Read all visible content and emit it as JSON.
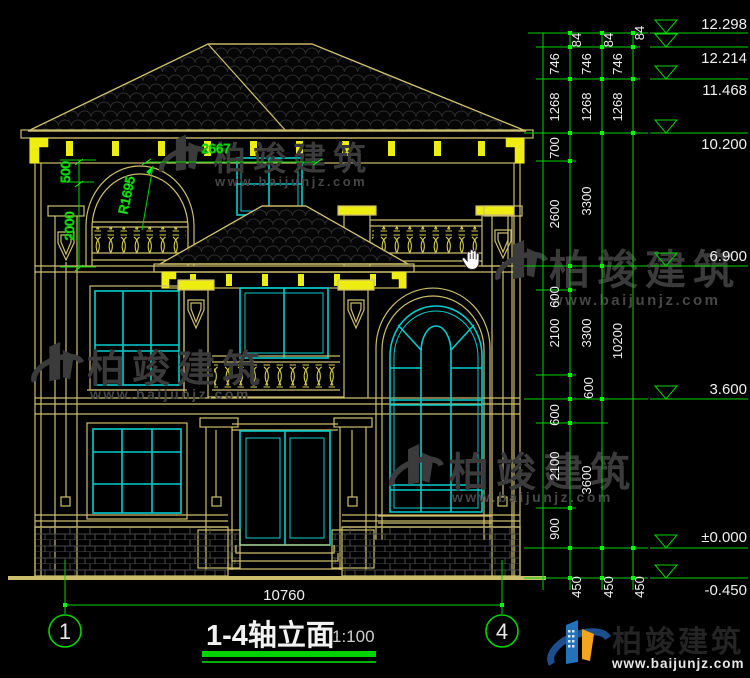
{
  "drawing": {
    "title": "1-4轴立面",
    "scale": "1:100",
    "axis_bubble_left": "1",
    "axis_bubble_right": "4",
    "bottom_overall_dim": "10760"
  },
  "left_dims": {
    "arch_width": "2667",
    "arch_radius": "R1695",
    "upper": "500",
    "lower": "2000"
  },
  "right_dims": {
    "chain1": [
      "84",
      "746",
      "1268",
      "700",
      "2600",
      "600",
      "2100",
      "600",
      "600",
      "2100",
      "900",
      "450"
    ],
    "chain2": [
      "84",
      "746",
      "1268",
      "3300",
      "3300",
      "3600",
      "450"
    ],
    "chain3": [
      "84",
      "746",
      "1268",
      "10200",
      "450"
    ]
  },
  "elevations": [
    "12.298",
    "12.214",
    "11.468",
    "10.200",
    "6.900",
    "3.600",
    "±0.000",
    "-0.450"
  ],
  "watermark": {
    "name": "柏竣建筑",
    "url": "www.baijunjz.com"
  },
  "logo": {
    "name": "柏竣建筑",
    "url": "www.baijunjz.com"
  },
  "cursor": {
    "type": "hand"
  },
  "colors": {
    "background": "#000000",
    "line_yellow": "#cdbe6e",
    "accent_yellow": "#eded12",
    "window_cyan": "#00cdcd",
    "dim_green": "#00d400",
    "text_white": "#efefef",
    "watermark_gray": "#3b3b3b",
    "logo_blue": "#2472b8",
    "logo_orange": "#f5a41e"
  }
}
